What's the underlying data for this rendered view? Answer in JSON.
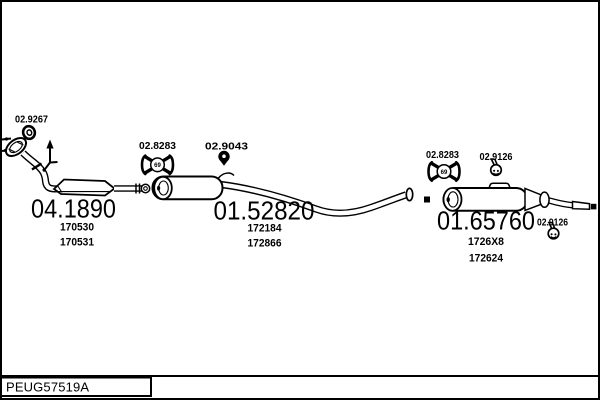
{
  "footer": {
    "code": "PEUG57519A"
  },
  "parts": {
    "front": {
      "number": "04.1890",
      "refs": [
        "170530",
        "170531"
      ]
    },
    "centre": {
      "number": "01.52820",
      "refs": [
        "172184",
        "172866"
      ]
    },
    "rear": {
      "number": "01.65760",
      "refs": [
        "1726X8",
        "172624"
      ]
    }
  },
  "fittings": {
    "gasket": "02.9267",
    "hanger_front": "02.8283",
    "hanger_mid": "02.9043",
    "hanger_rear": "02.8283",
    "clamp_rear_top": "02.9126",
    "clamp_tail": "02.9126",
    "hanger_mark": "69"
  },
  "icons": {
    "gasket": "ring-gasket-icon",
    "hanger_front": "rubber-hanger-icon",
    "hanger_mid": "pin-hanger-icon",
    "hanger_rear": "rubber-hanger-icon",
    "clamp_rear_top": "clamp-icon",
    "clamp_tail": "clamp-icon",
    "direction": "up-arrow-hanger-icon"
  },
  "colors": {
    "line": "#000000",
    "background": "#ffffff"
  }
}
